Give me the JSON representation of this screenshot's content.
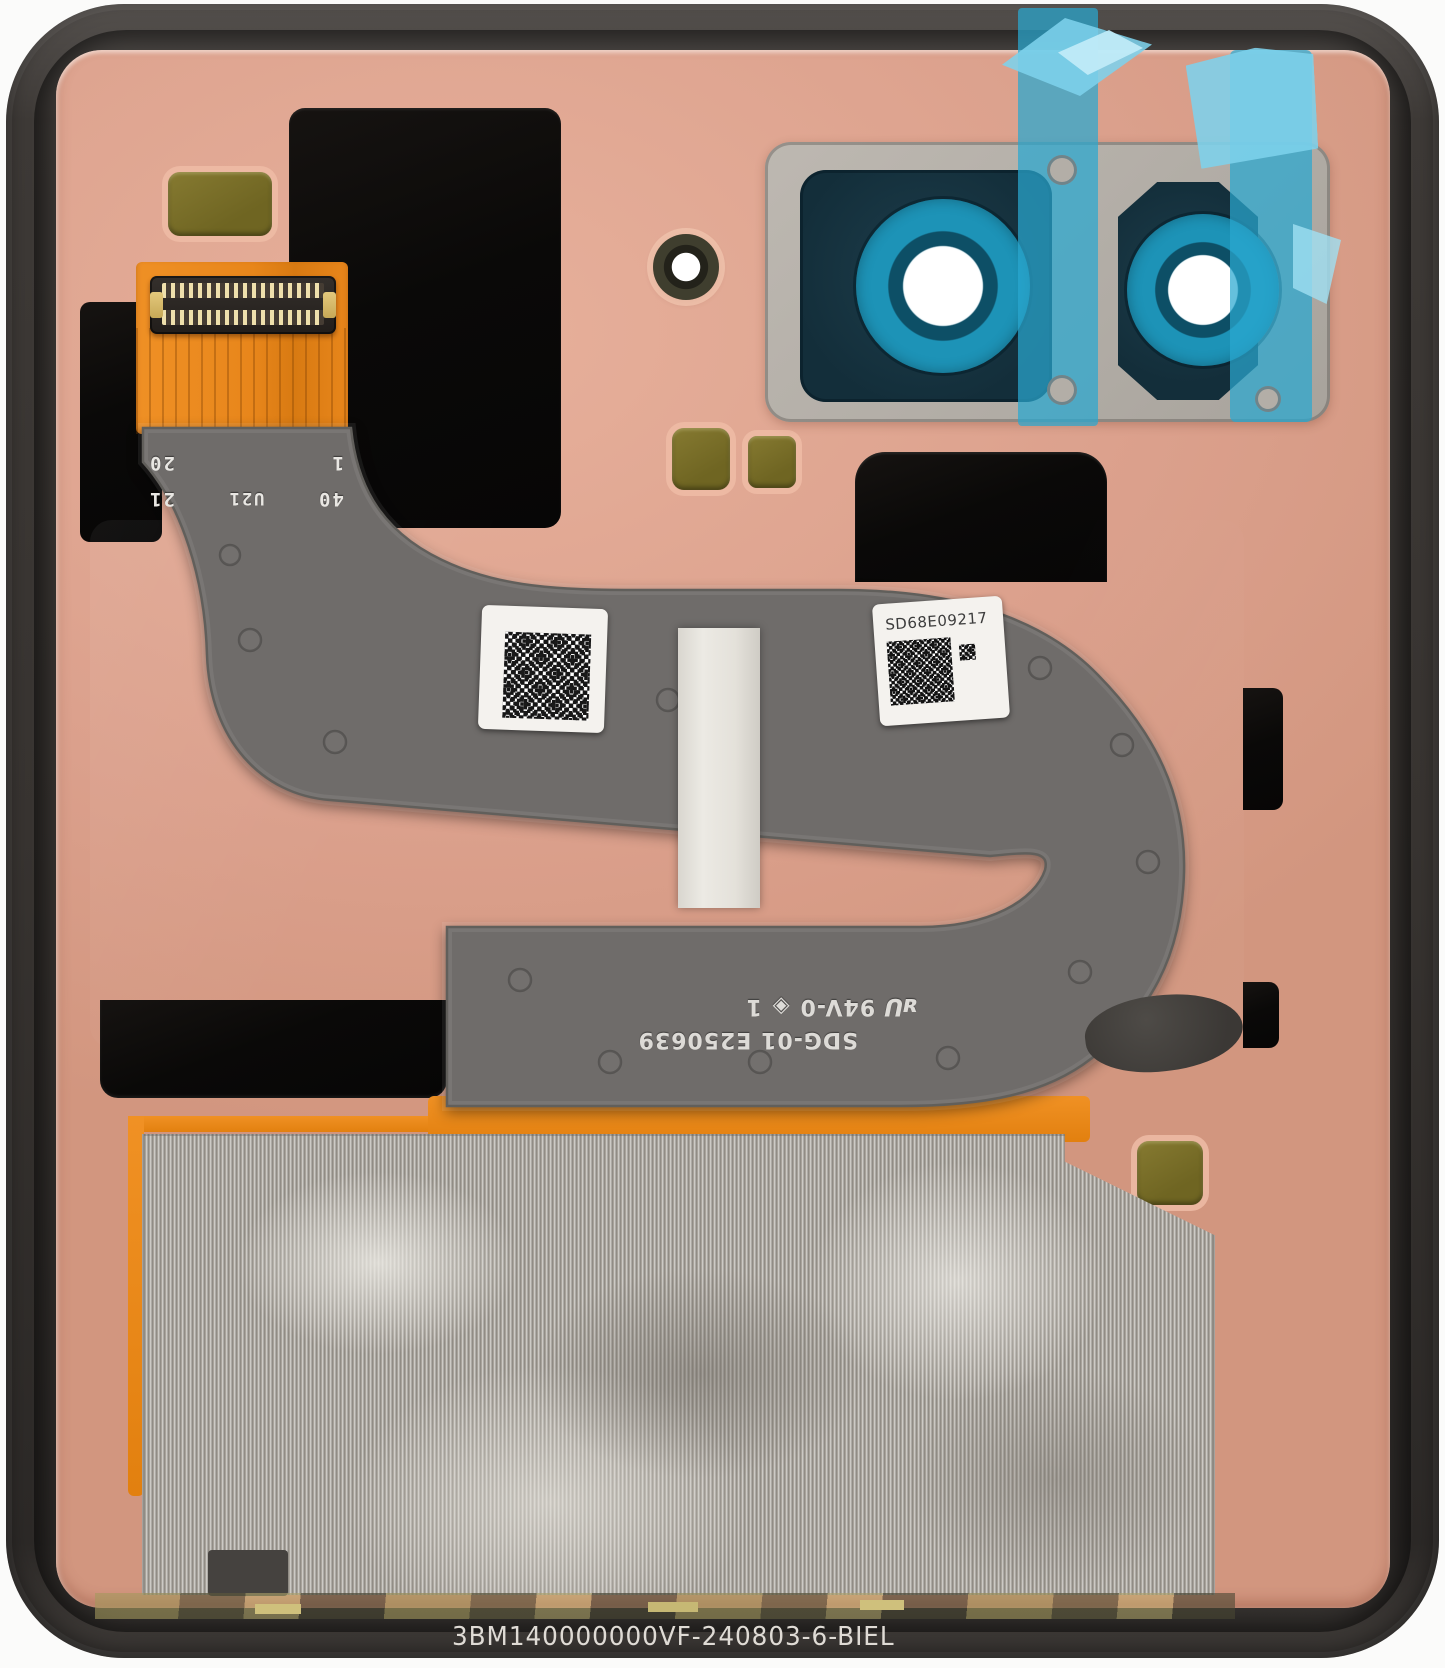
{
  "scene": {
    "description": "Photograph of a foldable smartphone back housing inner assembly with flex cable, camera lens bracket, adhesive films and labels",
    "bottom_code": "3BM140000000VF-240803-6-BIEL"
  },
  "markings": {
    "connector": {
      "row1": [
        "40",
        "U21",
        "21"
      ],
      "row2": [
        "1",
        "20"
      ]
    },
    "flex": {
      "line1": "SDG-01 E250639",
      "ul_mark": "ᴚU",
      "cert": "94V-0",
      "symbol": "◈",
      "num": "1"
    },
    "serial": "SD68E09217"
  },
  "colors": {
    "frame": "#38342f",
    "plate_pink": "#dba08c",
    "flex_gray": "#6f6c6a",
    "black_panel": "#0b0a09",
    "orange_flex": "#e8861b",
    "tape_blue": "#29a7d0",
    "lens_ring_cyan": "#1d93b7",
    "camera_plate_gray": "#b3aea7",
    "mesh_silver": "#a8a39b",
    "pad_olive": "#7d7229"
  }
}
